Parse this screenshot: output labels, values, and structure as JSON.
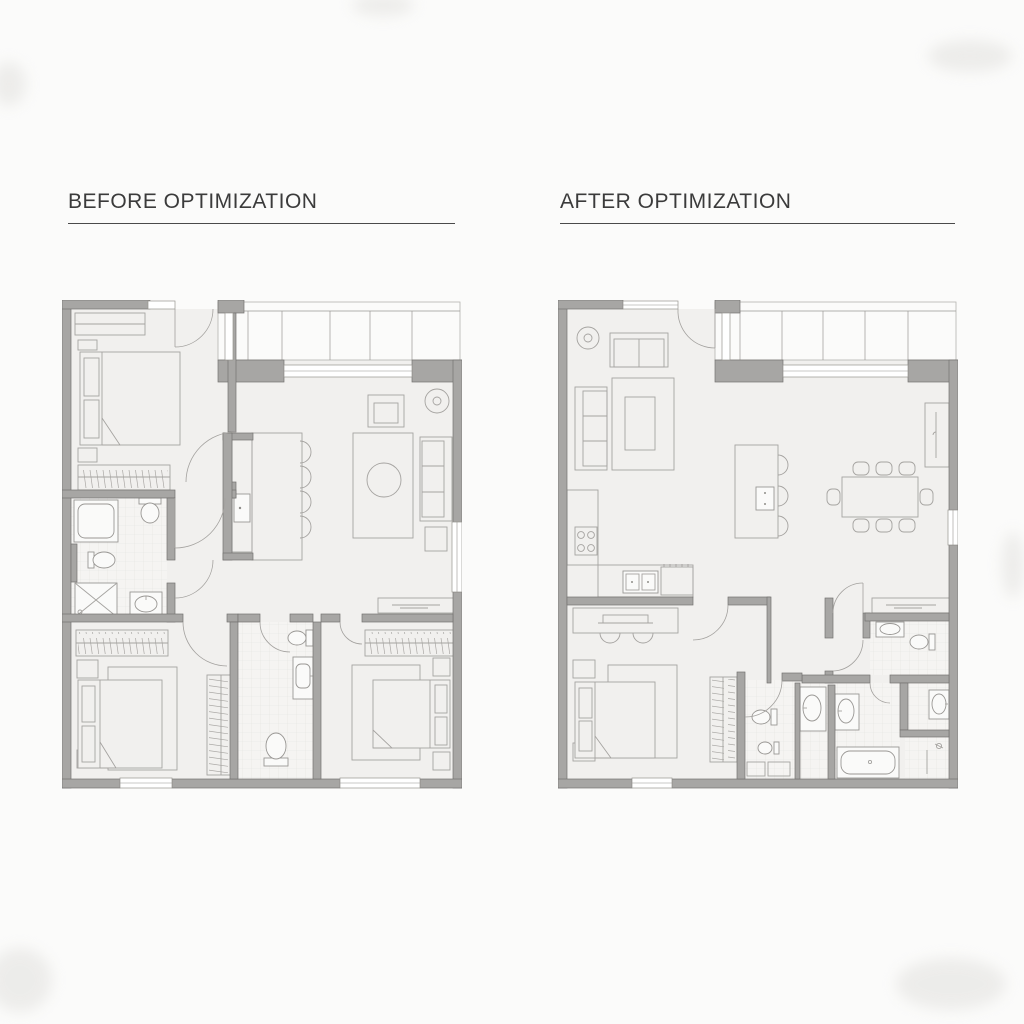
{
  "page": {
    "background": "#fbfbfa",
    "type": "architectural-floor-plan-comparison"
  },
  "palette": {
    "wall": "#a7a6a4",
    "wall_outline": "#747371",
    "floor": "#f1f0ee",
    "furniture_line": "#a5a3a0",
    "tile_line": "#e3e2e0",
    "title_text": "#3b3b3b",
    "title_underline": "#4a4a4a"
  },
  "panels": [
    {
      "id": "before",
      "title": "BEFORE OPTIMIZATION",
      "rooms": [
        {
          "name": "bedroom-1",
          "furniture": [
            "dresser",
            "double-bed",
            "nightstand",
            "nightstand",
            "wardrobe-with-hangers"
          ]
        },
        {
          "name": "balcony",
          "furniture": [
            "glazed-window-band"
          ]
        },
        {
          "name": "living-room",
          "furniture": [
            "armchair",
            "floor-lamp",
            "rug",
            "round-coffee-table",
            "sofa",
            "side-table",
            "desk"
          ]
        },
        {
          "name": "kitchen",
          "furniture": [
            "island-counter",
            "sink",
            "bar-stool",
            "bar-stool",
            "bar-stool",
            "bar-stool"
          ]
        },
        {
          "name": "bathroom-1",
          "furniture": [
            "bathtub",
            "toilet",
            "bidet",
            "shower",
            "sink"
          ]
        },
        {
          "name": "bedroom-2",
          "furniture": [
            "wardrobe-with-hangers",
            "double-bed",
            "nightstand",
            "nightstand",
            "tall-closet"
          ]
        },
        {
          "name": "bathroom-2",
          "furniture": [
            "wall-hung-toilet",
            "sink",
            "toilet"
          ]
        },
        {
          "name": "bedroom-3",
          "furniture": [
            "wardrobe-with-hangers",
            "double-bed",
            "nightstand",
            "nightstand",
            "rug"
          ]
        }
      ]
    },
    {
      "id": "after",
      "title": "AFTER OPTIMIZATION",
      "rooms": [
        {
          "name": "open-living-dining-kitchen",
          "furniture": [
            "floor-lamp",
            "loveseat",
            "sofa",
            "rug",
            "coffee-table",
            "kitchen-counter",
            "cooktop",
            "double-sink",
            "appliance",
            "kitchen-island",
            "bar-stool",
            "bar-stool",
            "bar-stool",
            "dining-table",
            "dining-chair-x8",
            "console",
            "desk"
          ]
        },
        {
          "name": "balcony",
          "furniture": [
            "glazed-window-band"
          ]
        },
        {
          "name": "master-bedroom",
          "furniture": [
            "desk",
            "desk-chair",
            "desk-chair",
            "double-bed",
            "nightstand",
            "nightstand",
            "rug",
            "walk-in-wardrobe"
          ]
        },
        {
          "name": "master-bathroom",
          "furniture": [
            "toilet",
            "bidet",
            "storage",
            "storage"
          ]
        },
        {
          "name": "guest-wc",
          "furniture": [
            "sink",
            "toilet"
          ]
        },
        {
          "name": "bathroom",
          "furniture": [
            "vanity-sink",
            "vanity-sink",
            "bathtub",
            "sink",
            "shower"
          ]
        }
      ]
    }
  ]
}
